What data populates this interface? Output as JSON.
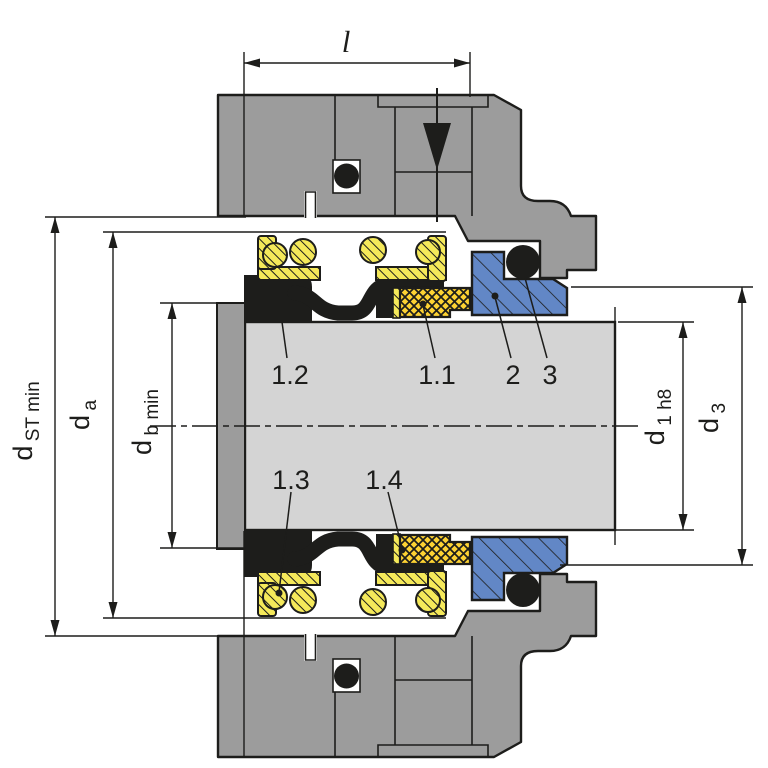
{
  "diagram": {
    "title": "mechanical-seal-cross-section-installation-drawing",
    "dimension_labels": {
      "length": "l",
      "d_st": {
        "main": "d",
        "sub": "ST min"
      },
      "d_a": {
        "main": "d",
        "sub": "a"
      },
      "d_b": {
        "main": "d",
        "sub": "b min"
      },
      "d_1": {
        "main": "d",
        "sub": "1 h8"
      },
      "d_3": {
        "main": "d",
        "sub": "3"
      }
    },
    "part_labels": {
      "p12": "1.2",
      "p11": "1.1",
      "p2": "2",
      "p3": "3",
      "p13": "1.3",
      "p14": "1.4"
    },
    "colors": {
      "housing_gray": "#9c9c9c",
      "shaft_gray": "#d4d4d4",
      "spring_yellow": "#f5e95a",
      "face_gold": "#fdd233",
      "seat_blue": "#6287c6",
      "part_black": "#1d1d1b",
      "line_black": "#1d1d1b",
      "background": "#ffffff"
    }
  }
}
